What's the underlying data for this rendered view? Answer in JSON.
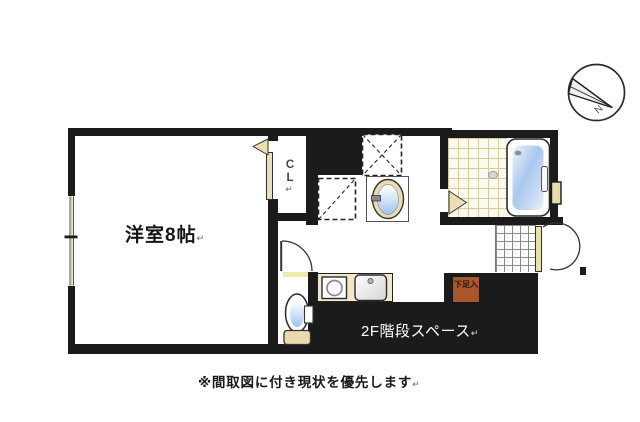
{
  "plan": {
    "room": {
      "label": "洋室8帖"
    },
    "closet": {
      "label": "CL"
    },
    "stairs": {
      "label": "2F階段スペース"
    },
    "shoe_cabinet": {
      "label": "下足入"
    },
    "compass": {
      "label": "N"
    },
    "caption": {
      "label": "※間取図に付き現状を優先します"
    },
    "return_mark": "↵"
  },
  "colors": {
    "wall": "#1b1b1b",
    "door_beige": "#e9dfb0",
    "counter_cream": "#f1e8cc",
    "shoe_brown": "#a8572a",
    "threshold_yellow": "#eeeab0",
    "tile_line": "#d6caa0",
    "genkan_line": "#8a8a8a",
    "tub_blue": "#a9c7ed"
  }
}
